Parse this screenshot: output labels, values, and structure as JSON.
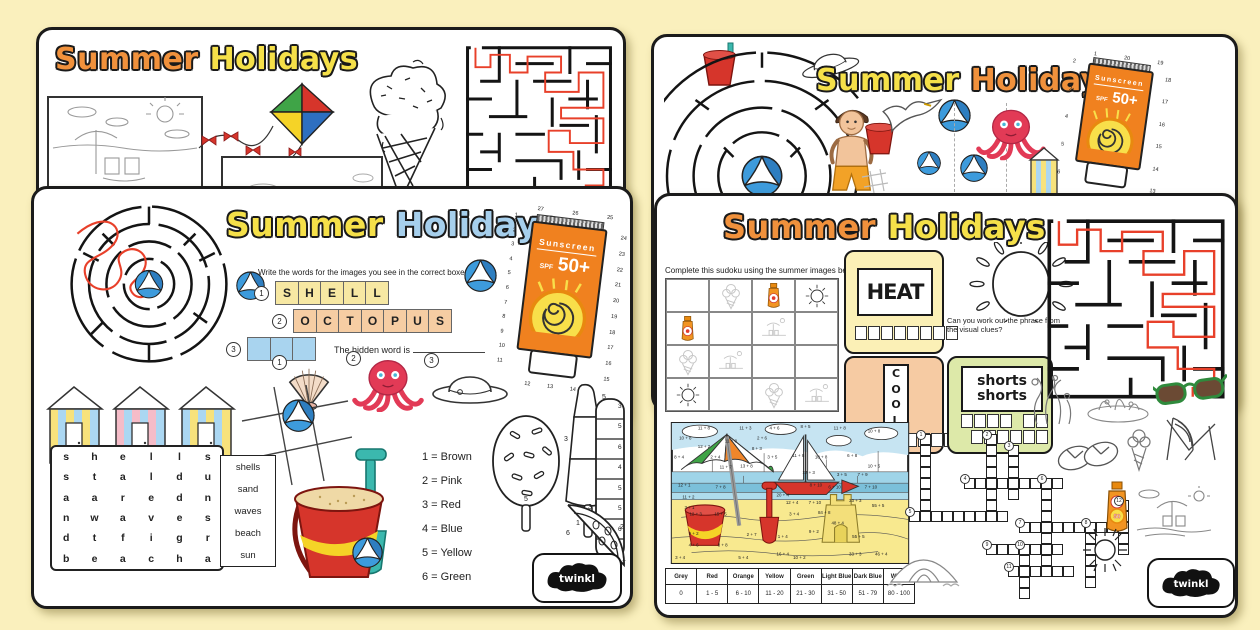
{
  "colors": {
    "accent_orange": "#F0913C",
    "accent_yellow": "#F5E049",
    "accent_blue": "#A6CFEC",
    "maze_path": "#E8402A",
    "bucket_red": "#D6352B",
    "spade_teal": "#3BB8AE",
    "octopus": "#E23A56"
  },
  "left_back": {
    "title1": "Summer",
    "title2": "Holidays"
  },
  "left_front": {
    "title1": "Summer",
    "title2": "Holidays",
    "instruction": "Write the words for the images you see in the correct boxes.",
    "rows": [
      {
        "num": "1",
        "cells": [
          "S",
          "H",
          "E",
          "L",
          "L"
        ]
      },
      {
        "num": "2",
        "cells": [
          "O",
          "C",
          "T",
          "O",
          "P",
          "U",
          "S"
        ]
      },
      {
        "num": "3",
        "cells": [
          "",
          "",
          ""
        ]
      }
    ],
    "hidden_label": "The hidden word is",
    "pic_nums": [
      "1",
      "2",
      "3"
    ],
    "sunscreen": {
      "brand": "Sunscreen",
      "spf": "SPF",
      "spf_val": "50+"
    },
    "dots_left": [
      "1",
      "2",
      "3",
      "4",
      "5",
      "6",
      "7",
      "8",
      "9",
      "10",
      "11"
    ],
    "dots_right": [
      "24",
      "23",
      "22",
      "21",
      "20",
      "19",
      "18",
      "17",
      "16",
      "15"
    ],
    "dots_top": [
      "27",
      "26",
      "25"
    ],
    "dots_bottom": [
      "12",
      "13",
      "14"
    ],
    "wordsearch": [
      [
        "s",
        "h",
        "e",
        "l",
        "l",
        "s"
      ],
      [
        "s",
        "t",
        "a",
        "l",
        "d",
        "u"
      ],
      [
        "a",
        "a",
        "r",
        "e",
        "d",
        "n"
      ],
      [
        "n",
        "w",
        "a",
        "v",
        "e",
        "s"
      ],
      [
        "d",
        "t",
        "f",
        "i",
        "g",
        "r"
      ],
      [
        "b",
        "e",
        "a",
        "c",
        "h",
        "a"
      ]
    ],
    "words": [
      "shells",
      "sand",
      "waves",
      "beach",
      "sun"
    ],
    "color_key": [
      "1 = Brown",
      "2 = Pink",
      "3 = Red",
      "4 = Blue",
      "5 = Yellow",
      "6 = Green"
    ],
    "lolly_oval_num": "5",
    "lolly_rocket_nums": [
      "5",
      "3",
      "5",
      "1"
    ],
    "lolly_stripe_nums": [
      "3",
      "5",
      "6",
      "4",
      "5",
      "5",
      "6",
      "6"
    ],
    "melon_nums": [
      "3",
      "6",
      "2",
      "1"
    ],
    "logo": "twinkl"
  },
  "right_back": {
    "title1": "Summer",
    "title2": "Holidays",
    "sunscreen": {
      "brand": "Sunscreen",
      "spf": "SPF",
      "spf_val": "50+"
    },
    "dots_left": [
      "2",
      "3",
      "4",
      "5",
      "6"
    ],
    "dots_right": [
      "18",
      "17",
      "16",
      "15",
      "14",
      "13"
    ],
    "dots_top": [
      "1",
      "20",
      "19"
    ]
  },
  "right_front": {
    "title1": "Summer",
    "title2": "Holidays",
    "sudoku_instruction": "Complete this sudoku using the summer images below.",
    "sudoku": [
      [
        "",
        "icecream",
        "sunscreen",
        "sun"
      ],
      [
        "sunscreen",
        "",
        "beach",
        ""
      ],
      [
        "icecream",
        "beach",
        "",
        ""
      ],
      [
        "sun",
        "",
        "icecream",
        "beach"
      ]
    ],
    "heat": "HEAT",
    "phrase_q": "Can you work out the phrase from the visual clues?",
    "cool": [
      "C",
      "O",
      "O",
      "L"
    ],
    "shorts1": "shorts",
    "shorts2": "shorts",
    "table_headers": [
      "Grey",
      "Red",
      "Orange",
      "Yellow",
      "Green",
      "Light Blue",
      "Dark Blue",
      "White"
    ],
    "table_values": [
      "0",
      "1 - 5",
      "6 - 10",
      "11 - 20",
      "21 - 30",
      "31 - 50",
      "51 - 79",
      "80 - 100"
    ],
    "bottle_label": "50",
    "sums": [
      [
        32,
        7,
        "11 + 8"
      ],
      [
        72,
        7,
        "11 + 3"
      ],
      [
        100,
        7,
        "4 + 6"
      ],
      [
        130,
        6,
        "8 + 5"
      ],
      [
        163,
        7,
        "11 + 8"
      ],
      [
        196,
        10,
        "10 + 8"
      ],
      [
        14,
        17,
        "10 + 8"
      ],
      [
        58,
        20,
        "11 + 8"
      ],
      [
        88,
        17,
        "2 + 6"
      ],
      [
        32,
        25,
        "12 + 2"
      ],
      [
        83,
        27,
        "8 + 3"
      ],
      [
        8,
        35,
        "8 + 4"
      ],
      [
        43,
        35,
        "2 + 4"
      ],
      [
        98,
        35,
        "3 + 5"
      ],
      [
        123,
        34,
        "11 + 8"
      ],
      [
        145,
        35,
        "10 + 8"
      ],
      [
        175,
        34,
        "6 + 8"
      ],
      [
        53,
        45,
        "11 + 7"
      ],
      [
        73,
        44,
        "13 + 8"
      ],
      [
        133,
        50,
        "12 + 3"
      ],
      [
        165,
        52,
        "3 + 5"
      ],
      [
        185,
        52,
        "7 + 9"
      ],
      [
        196,
        44,
        "10 + 5"
      ],
      [
        13,
        62,
        "12 + 1"
      ],
      [
        48,
        64,
        "7 + 8"
      ],
      [
        140,
        62,
        "8 + 10"
      ],
      [
        158,
        64,
        "6 + 10"
      ],
      [
        193,
        64,
        "7 + 10"
      ],
      [
        17,
        74,
        "11 + 2"
      ],
      [
        108,
        72,
        "20 + 4"
      ],
      [
        117,
        79,
        "12 + 4"
      ],
      [
        139,
        79,
        "7 + 10"
      ],
      [
        178,
        77,
        "33 + 3"
      ],
      [
        200,
        82,
        "55 + 5"
      ],
      [
        18,
        84,
        "3 + 1"
      ],
      [
        24,
        90,
        "12 + 3"
      ],
      [
        48,
        90,
        "15 + 5"
      ],
      [
        119,
        90,
        "3 + 4"
      ],
      [
        148,
        89,
        "84 + 8"
      ],
      [
        161,
        99,
        "48 + 4"
      ],
      [
        22,
        109,
        "9 + 2"
      ],
      [
        78,
        110,
        "2 + 7"
      ],
      [
        108,
        112,
        "1 + 4"
      ],
      [
        138,
        107,
        "9 + 2"
      ],
      [
        181,
        112,
        "55 + 5"
      ],
      [
        22,
        120,
        "4 + 6"
      ],
      [
        50,
        120,
        "8 + 8"
      ],
      [
        108,
        129,
        "16 + 4"
      ],
      [
        178,
        129,
        "33 + 3"
      ],
      [
        203,
        129,
        "46 + 4"
      ],
      [
        9,
        132,
        "3 + 4"
      ],
      [
        70,
        132,
        "5 + 4"
      ],
      [
        124,
        132,
        "10 + 2"
      ]
    ],
    "crossword": [
      {
        "num": "1",
        "dir": "v",
        "c": 1,
        "r": 0,
        "len": 7
      },
      {
        "num": "2",
        "dir": "v",
        "c": 7,
        "r": 0,
        "len": 8
      },
      {
        "num": "3",
        "dir": "v",
        "c": 9,
        "r": 1,
        "len": 5
      },
      {
        "num": "4",
        "dir": "h",
        "c": 5,
        "r": 4,
        "len": 9
      },
      {
        "num": "5",
        "dir": "h",
        "c": 0,
        "r": 7,
        "len": 9
      },
      {
        "num": "6",
        "dir": "v",
        "c": 12,
        "r": 4,
        "len": 9
      },
      {
        "num": "7",
        "dir": "h",
        "c": 10,
        "r": 8,
        "len": 9
      },
      {
        "num": "8",
        "dir": "v",
        "c": 16,
        "r": 8,
        "len": 6
      },
      {
        "num": "9",
        "dir": "h",
        "c": 7,
        "r": 10,
        "len": 7
      },
      {
        "num": "10",
        "dir": "v",
        "c": 10,
        "r": 10,
        "len": 5
      },
      {
        "num": "11",
        "dir": "h",
        "c": 9,
        "r": 12,
        "len": 6
      },
      {
        "num": "12",
        "dir": "v",
        "c": 19,
        "r": 6,
        "len": 5
      }
    ],
    "logo": "twinkl"
  }
}
